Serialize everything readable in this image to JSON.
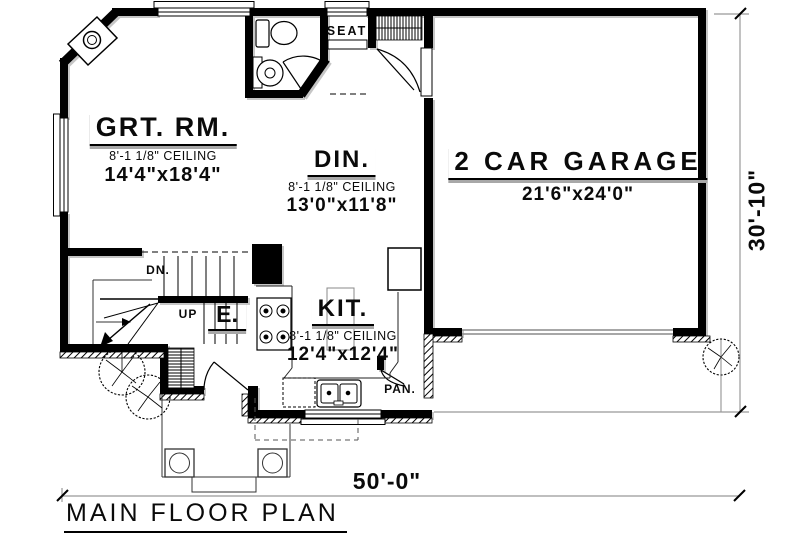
{
  "plan": {
    "title": "MAIN FLOOR PLAN",
    "dimensions": {
      "overall_width": "50'-0\"",
      "overall_depth": "30'-10\""
    },
    "rooms": {
      "great_room": {
        "name": "GRT. RM.",
        "ceiling": "8'-1 1/8\" CEILING",
        "size": "14'4\"x18'4\""
      },
      "dining": {
        "name": "DIN.",
        "ceiling": "8'-1 1/8\" CEILING",
        "size": "13'0\"x11'8\""
      },
      "kitchen": {
        "name": "KIT.",
        "ceiling": "8'-1 1/8\" CEILING",
        "size": "12'4\"x12'4\""
      },
      "garage": {
        "name": "2 CAR GARAGE",
        "size": "21'6\"x24'0\""
      },
      "entry": {
        "name": "E."
      }
    },
    "annotations": {
      "seat": "SEAT",
      "stairs_down": "DN.",
      "stairs_up": "UP",
      "pantry": "PAN."
    },
    "colors": {
      "wall": "#000000",
      "dimension_line": "#999999",
      "shadow": "#b8b8b8",
      "paper": "#ffffff"
    }
  }
}
